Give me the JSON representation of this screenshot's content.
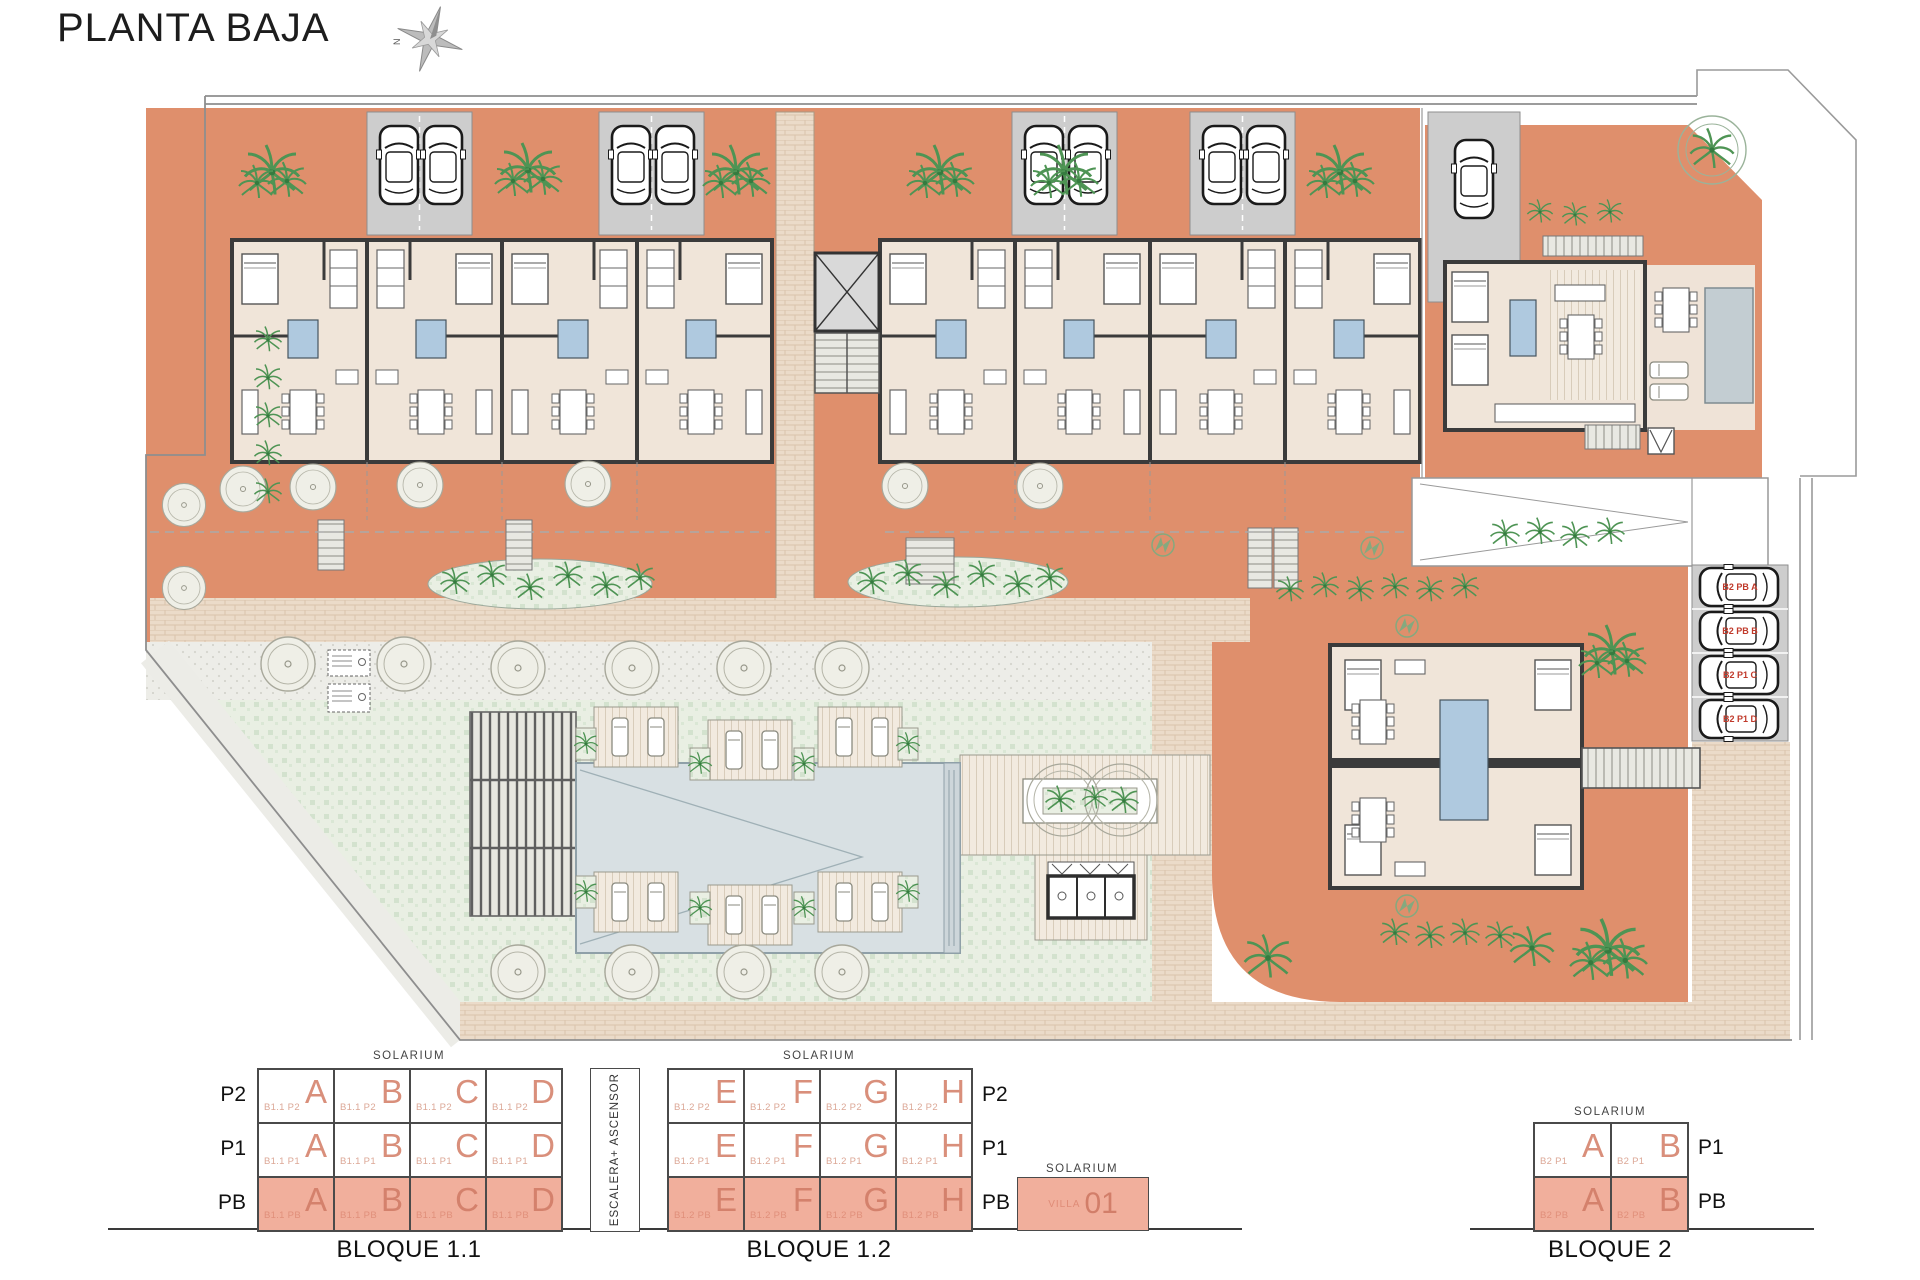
{
  "title": "PLANTA BAJA",
  "compass": {
    "north": "N"
  },
  "colors": {
    "terracotta": "#DF8F6C",
    "legend_fill": "#F1AF9C",
    "legend_text": "#D98F7B",
    "lawn": "#E9EFE3",
    "pool": "#D8E0E3",
    "parking_label_red": "#C03A2B",
    "wall": "#3B3B3B"
  },
  "plan": {
    "parking": [
      "B2 PB A",
      "B2 PB B",
      "B2 P1 C",
      "B2 P1 D"
    ]
  },
  "legend": {
    "bloque11": {
      "caption": "BLOQUE 1.1",
      "solarium": "SOLARIUM",
      "rows": [
        {
          "floor": "P2",
          "cells": [
            {
              "code": "B1.1 P2",
              "letter": "A"
            },
            {
              "code": "B1.1 P2",
              "letter": "B"
            },
            {
              "code": "B1.1 P2",
              "letter": "C"
            },
            {
              "code": "B1.1 P2",
              "letter": "D"
            }
          ]
        },
        {
          "floor": "P1",
          "cells": [
            {
              "code": "B1.1 P1",
              "letter": "A"
            },
            {
              "code": "B1.1 P1",
              "letter": "B"
            },
            {
              "code": "B1.1 P1",
              "letter": "C"
            },
            {
              "code": "B1.1 P1",
              "letter": "D"
            }
          ]
        },
        {
          "floor": "PB",
          "cells": [
            {
              "code": "B1.1 PB",
              "letter": "A"
            },
            {
              "code": "B1.1 PB",
              "letter": "B"
            },
            {
              "code": "B1.1 PB",
              "letter": "C"
            },
            {
              "code": "B1.1 PB",
              "letter": "D"
            }
          ]
        }
      ]
    },
    "stair_core": "ESCALERA+ ASCENSOR",
    "bloque12": {
      "caption": "BLOQUE 1.2",
      "solarium": "SOLARIUM",
      "rows": [
        {
          "floor": "P2",
          "cells": [
            {
              "code": "B1.2 P2",
              "letter": "E"
            },
            {
              "code": "B1.2 P2",
              "letter": "F"
            },
            {
              "code": "B1.2 P2",
              "letter": "G"
            },
            {
              "code": "B1.2 P2",
              "letter": "H"
            }
          ]
        },
        {
          "floor": "P1",
          "cells": [
            {
              "code": "B1.2 P1",
              "letter": "E"
            },
            {
              "code": "B1.2 P1",
              "letter": "F"
            },
            {
              "code": "B1.2 P1",
              "letter": "G"
            },
            {
              "code": "B1.2 P1",
              "letter": "H"
            }
          ]
        },
        {
          "floor": "PB",
          "cells": [
            {
              "code": "B1.2 PB",
              "letter": "E"
            },
            {
              "code": "B1.2 PB",
              "letter": "F"
            },
            {
              "code": "B1.2 PB",
              "letter": "G"
            },
            {
              "code": "B1.2 PB",
              "letter": "H"
            }
          ]
        }
      ]
    },
    "villa": {
      "solarium": "SOLARIUM",
      "name": "VILLA",
      "number": "01"
    },
    "bloque2": {
      "caption": "BLOQUE 2",
      "solarium": "SOLARIUM",
      "rows": [
        {
          "floor": "P1",
          "cells": [
            {
              "code": "B2 P1",
              "letter": "A"
            },
            {
              "code": "B2 P1",
              "letter": "B"
            }
          ]
        },
        {
          "floor": "PB",
          "cells": [
            {
              "code": "B2 PB",
              "letter": "A"
            },
            {
              "code": "B2 PB",
              "letter": "B"
            }
          ]
        }
      ]
    }
  }
}
